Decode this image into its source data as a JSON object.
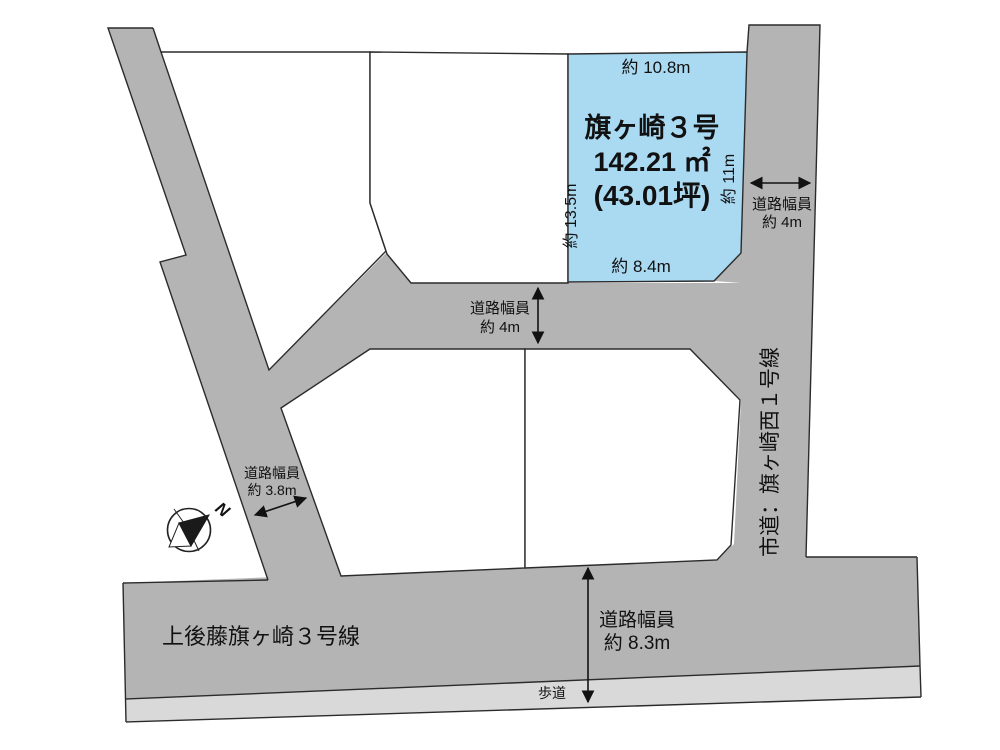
{
  "colors": {
    "road": "#b4b4b4",
    "sidewalk": "#d9d9d9",
    "parcel_fill": "#aad9f2",
    "parcel_white": "#ffffff",
    "line": "#2b2b2b",
    "text": "#111111"
  },
  "parcel": {
    "name": "旗ヶ崎３号",
    "area": "142.21 ㎡",
    "area_tsubo": "(43.01坪)",
    "dim_top": "約 10.8m",
    "dim_left": "約 13.5m",
    "dim_right": "約 11m",
    "dim_bottom": "約 8.4m"
  },
  "roads": {
    "width_caption": "道路幅員",
    "right": {
      "name": "市道：旗ヶ崎西１号線",
      "width": "約 4m"
    },
    "middle": {
      "width": "約 4m"
    },
    "left": {
      "width": "約 3.8m"
    },
    "bottom": {
      "name": "上後藤旗ヶ崎３号線",
      "width": "約 8.3m",
      "sidewalk_label": "歩道"
    }
  },
  "compass": {
    "north": "N"
  }
}
